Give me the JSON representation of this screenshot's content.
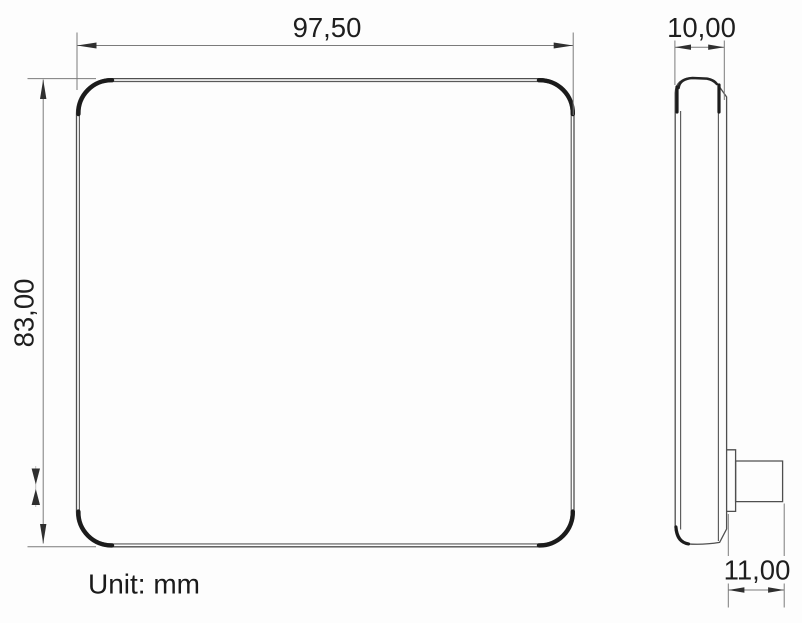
{
  "drawing": {
    "unit_note": "Unit: mm",
    "front_view": {
      "width": "97,50",
      "height": "83,00"
    },
    "side_view": {
      "thickness": "10,00",
      "protrusion_depth": "11,00"
    }
  },
  "colors": {
    "background": "#fdfdfd",
    "outline": "#4f4f4f",
    "corner_accent": "#1b1b1b",
    "dimension_line": "#7b7b7b",
    "arrowhead": "#2f2f2f",
    "text": "#1e1e1e"
  }
}
